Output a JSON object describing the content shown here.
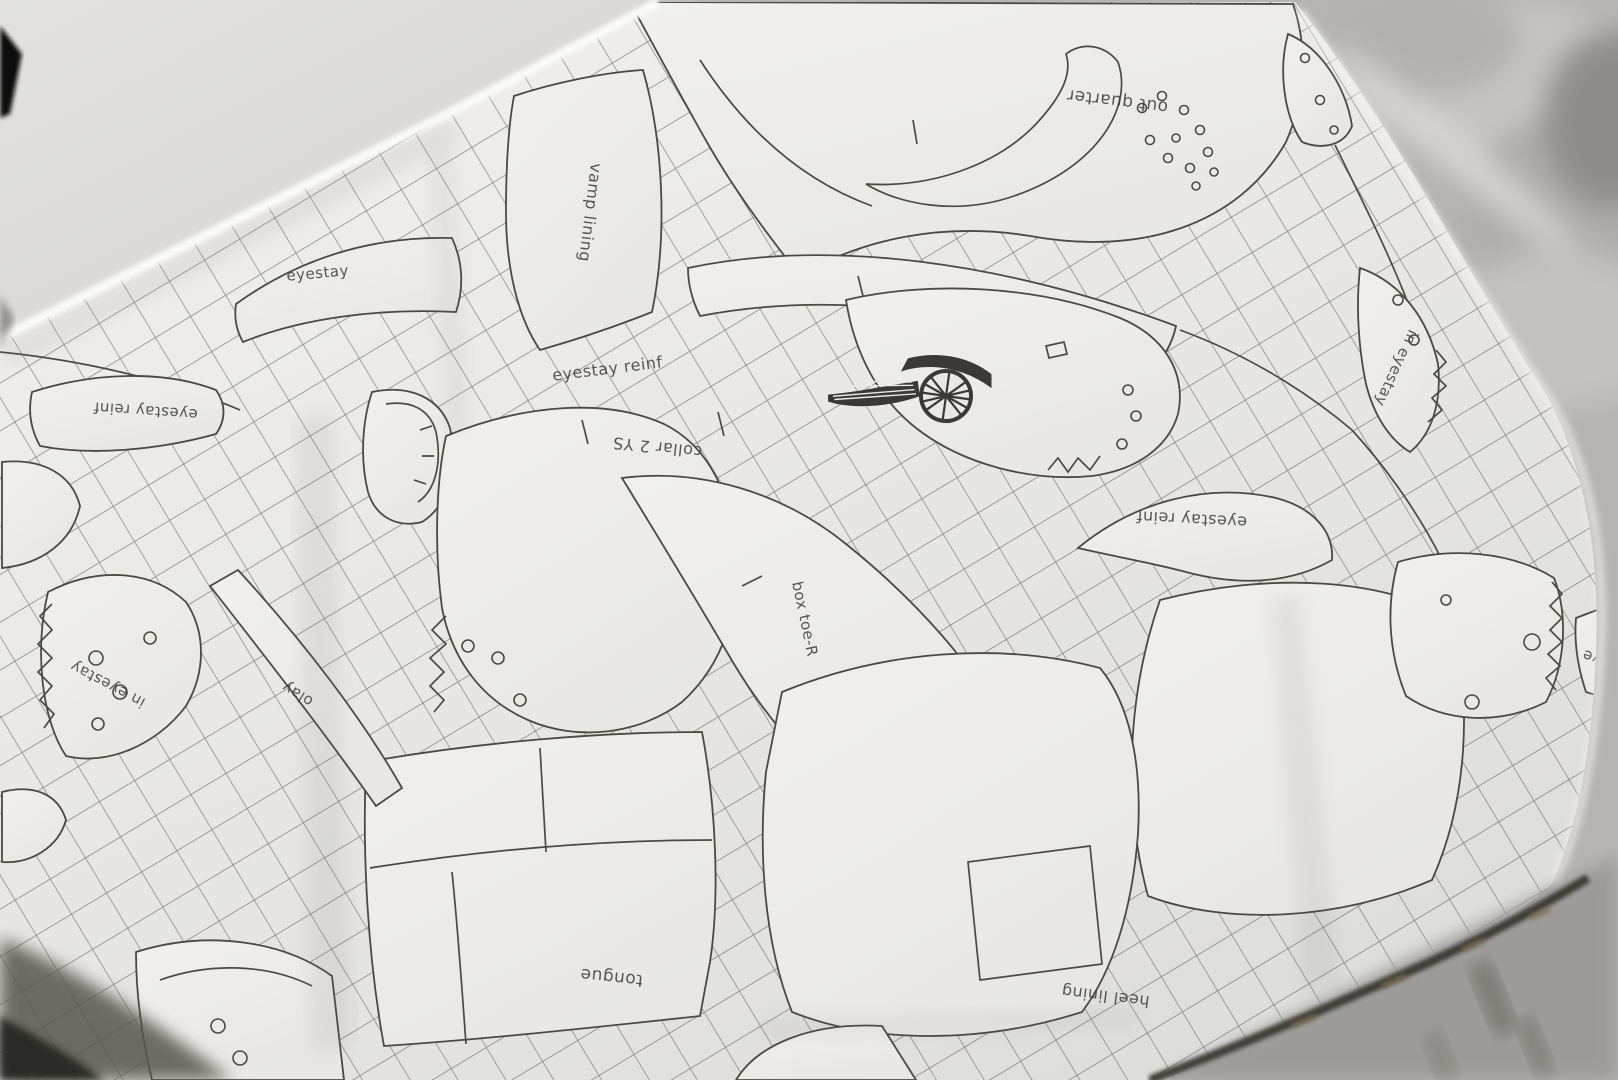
{
  "scene": "shoe-pattern tissue paper inside an open shoebox",
  "labels": {
    "out_quarter": "out quarter",
    "vamp_lining": "vamp lining",
    "eyestay": "eyestay",
    "eyestay_reinf": "eyestay reinf",
    "collar": "collar 2 YS",
    "in_eyestay": "in eyestay",
    "box_toe": "box toe-R",
    "olay": "olay",
    "tongue": "tongue",
    "heel_lining": "heel lining",
    "eye_partial": "eye"
  },
  "icons": {
    "wings_logo": "air-jordan-wings-logo"
  },
  "colors": {
    "paper": "#ecebe8",
    "pattern_line": "#4c4945",
    "crosshatch": "#57544f",
    "lid": "#dcdbd8",
    "blur_background": "#b5b4b2",
    "box_edge": "#36322b",
    "shadow": "#2c2b27",
    "logo": "#3b3835"
  }
}
